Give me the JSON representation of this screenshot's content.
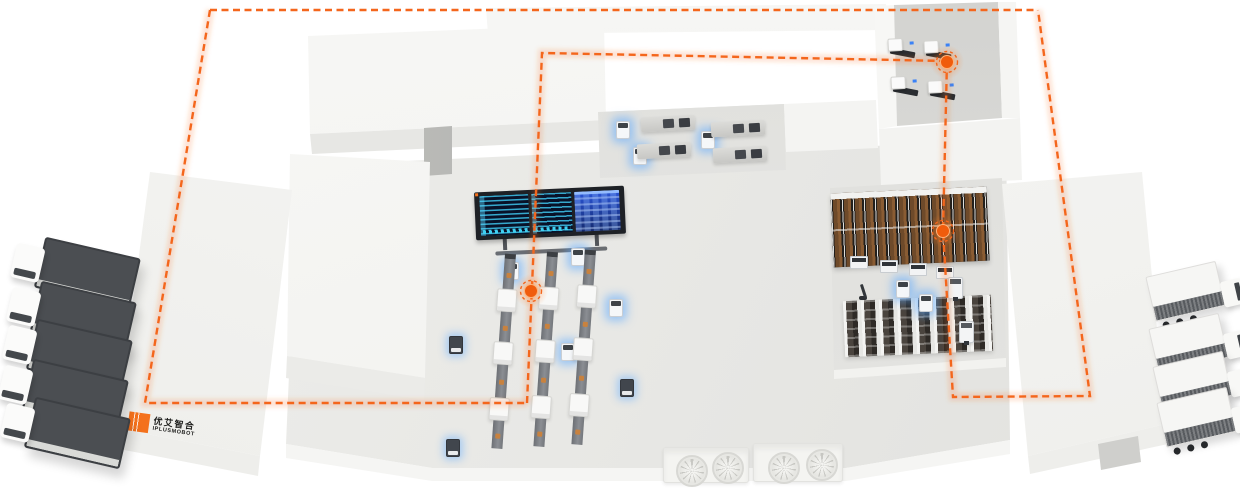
{
  "scene": {
    "kind": "isometric-smart-factory-illustration",
    "width": 1240,
    "height": 488,
    "background": "#ffffff"
  },
  "branding": {
    "logo_text_cn": "优艾智合",
    "logo_text_en": "IPLUSMOBOT"
  },
  "palette": {
    "logo_orange": "#f4711c",
    "route_orange": "#f4661c",
    "route_glow": "rgba(246,110,30,0.20)",
    "waypoint_core": "#f05c0c",
    "agv_glow_blue": "#5aa8ff",
    "screen_navy": "#081229",
    "screen_teal": "#3ec3eb",
    "screen_blue": "#2a55d8",
    "rack_box_brown": "#8a5c33",
    "trailer_gray": "#4b4e52"
  },
  "route": {
    "dash_paths": [
      "M210,10 L1038,10",
      "M210,10 L145,403 L527,403",
      "M527,403 L542,53 L947,61",
      "M947,61 L943,231 L953,397 L1090,396 L1038,10"
    ],
    "waypoints": [
      {
        "x": 947,
        "y": 62
      },
      {
        "x": 943,
        "y": 231
      },
      {
        "x": 531,
        "y": 291
      }
    ]
  },
  "vehicles": {
    "trucks_left": [
      {
        "x": 12,
        "y": 244,
        "rot": 13
      },
      {
        "x": 8,
        "y": 288,
        "rot": 13
      },
      {
        "x": 4,
        "y": 326,
        "rot": 13
      },
      {
        "x": 0,
        "y": 366,
        "rot": 13
      },
      {
        "x": 2,
        "y": 404,
        "rot": 13
      }
    ],
    "trucks_right": [
      {
        "x": 1150,
        "y": 266,
        "rot": -13
      },
      {
        "x": 1153,
        "y": 318,
        "rot": -13
      },
      {
        "x": 1157,
        "y": 356,
        "rot": -13
      },
      {
        "x": 1161,
        "y": 392,
        "rot": -13
      }
    ]
  },
  "robots": {
    "agvs": [
      {
        "x": 505,
        "y": 262,
        "variant": "light"
      },
      {
        "x": 571,
        "y": 248,
        "variant": "light"
      },
      {
        "x": 609,
        "y": 299,
        "variant": "light"
      },
      {
        "x": 561,
        "y": 343,
        "variant": "light"
      },
      {
        "x": 449,
        "y": 336,
        "variant": "dark"
      },
      {
        "x": 446,
        "y": 439,
        "variant": "dark"
      },
      {
        "x": 620,
        "y": 379,
        "variant": "dark"
      },
      {
        "x": 616,
        "y": 121,
        "variant": "light"
      },
      {
        "x": 701,
        "y": 131,
        "variant": "light"
      },
      {
        "x": 633,
        "y": 147,
        "variant": "light"
      },
      {
        "x": 896,
        "y": 280,
        "variant": "light"
      },
      {
        "x": 919,
        "y": 294,
        "variant": "light"
      }
    ],
    "docked_agvs": [
      {
        "x": 850,
        "y": 256
      },
      {
        "x": 880,
        "y": 260
      },
      {
        "x": 909,
        "y": 263
      },
      {
        "x": 936,
        "y": 266
      }
    ],
    "forklifts": [
      {
        "x": 948,
        "y": 277
      },
      {
        "x": 959,
        "y": 321
      }
    ],
    "arm": {
      "x": 855,
      "y": 284
    }
  },
  "equipment": {
    "production_lines": {
      "positions": [
        {
          "x": 500,
          "y": 254
        },
        {
          "x": 542,
          "y": 252
        },
        {
          "x": 580,
          "y": 250
        }
      ],
      "segments": [
        {
          "t": "conv",
          "h": 30,
          "item": true
        },
        {
          "t": "mach",
          "h": 23
        },
        {
          "t": "conv",
          "h": 30,
          "item": true
        },
        {
          "t": "mach",
          "h": 23
        },
        {
          "t": "conv",
          "h": 33,
          "item": true
        },
        {
          "t": "mach",
          "h": 23
        },
        {
          "t": "conv",
          "h": 28,
          "item": true
        }
      ]
    },
    "machining_units": [
      {
        "x": 641,
        "y": 116
      },
      {
        "x": 711,
        "y": 121
      },
      {
        "x": 637,
        "y": 143
      },
      {
        "x": 713,
        "y": 147
      }
    ],
    "cnc_machines": [
      {
        "x": 888,
        "y": 38
      },
      {
        "x": 924,
        "y": 40
      },
      {
        "x": 891,
        "y": 76
      },
      {
        "x": 928,
        "y": 80
      }
    ],
    "hvac_units": [
      {
        "x": 663,
        "y": 447,
        "w": 84,
        "h": 34,
        "fans": [
          [
            12,
            7
          ],
          [
            48,
            4
          ]
        ]
      },
      {
        "x": 753,
        "y": 443,
        "w": 88,
        "h": 37,
        "fans": [
          [
            14,
            8
          ],
          [
            52,
            5
          ]
        ]
      }
    ]
  }
}
